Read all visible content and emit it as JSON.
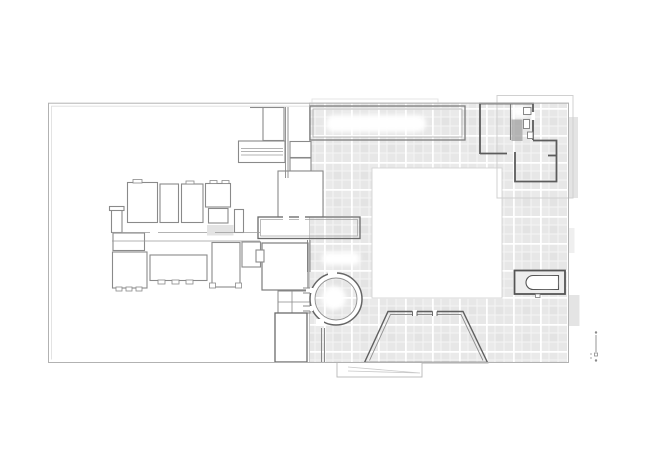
{
  "meta": {
    "kind": "architectural-site-plan",
    "visible_text": ""
  },
  "colors": {
    "background": "#ffffff",
    "tile": "#e7e7e7",
    "tile_alt": "#e0e0e0",
    "tile_soft": "#ededed",
    "grout": "#f4f4f4",
    "grout_strong": "#ffffff",
    "wall_dark": "#5c5c5c",
    "wall_medium": "#7d7d7d",
    "wall_light": "#9a9a9a",
    "outline_light": "#c8c8c8",
    "outline_faint": "#e0e0e0",
    "boundary": "#b2b2b2",
    "boundary_inner": "#dddddd",
    "fixture_gray": "#a0a0a0",
    "patch_gray": "#d9d9d9",
    "edge_bar": "#e4e4e4",
    "courtyard_border": "#d4d4d4",
    "ramp_line": "#c9c9c9",
    "marker_gray": "#8a8a8a"
  },
  "elements": [
    "site-boundary",
    "west-garden-area",
    "west-building-cluster",
    "connector-wing",
    "tiled-court",
    "central-courtyard",
    "north-loggia",
    "northeast-pavilion",
    "circular-room",
    "trapezoid-pool",
    "bath-basin",
    "ramp-platform",
    "right-edge-hedges",
    "scale-marker"
  ]
}
